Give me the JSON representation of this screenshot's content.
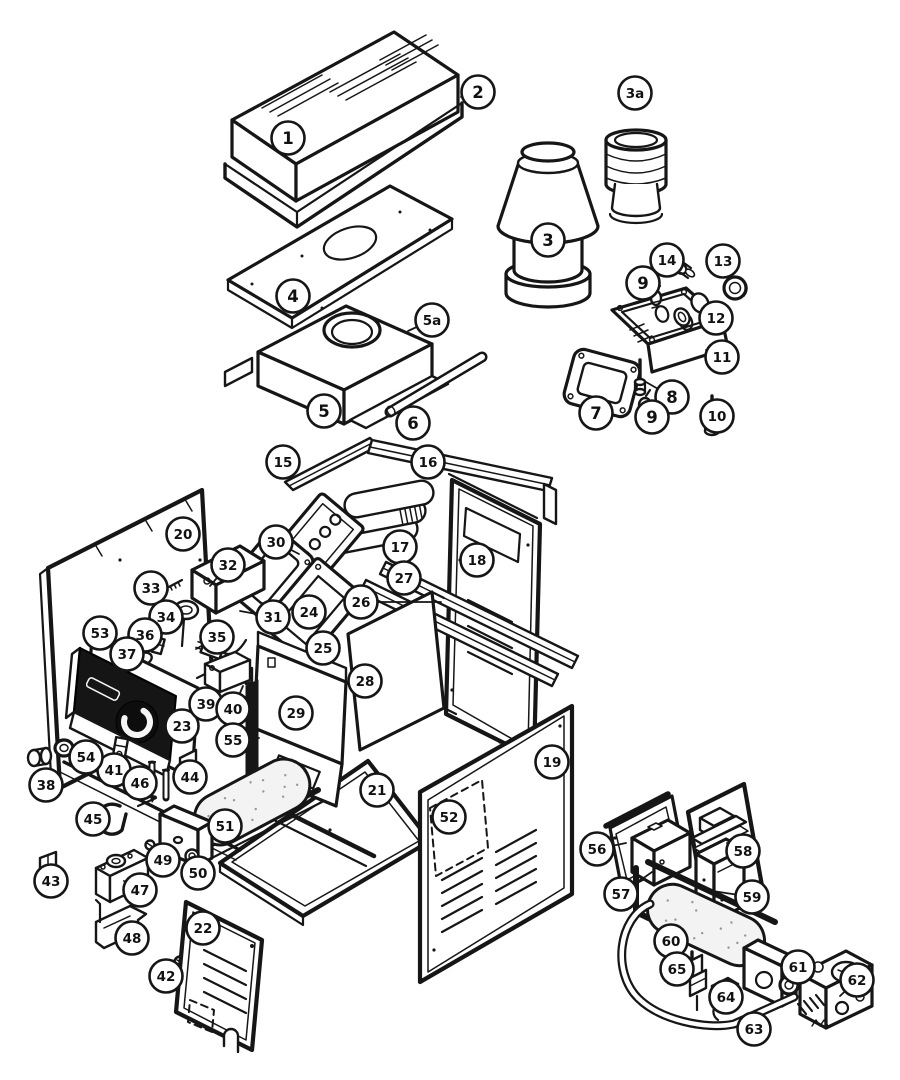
{
  "diagram": {
    "kind": "exploded-parts-diagram"
  },
  "style": {
    "line_color": "#161616",
    "background": "#ffffff",
    "panel_face_color": "#151515",
    "callout_radius": 16.5,
    "callout_font_size": 16.5,
    "callout_font_size_2char": 13.5
  },
  "callouts": [
    {
      "label": "1",
      "x": 288,
      "y": 138
    },
    {
      "label": "2",
      "x": 478,
      "y": 92,
      "leader": [
        461,
        97
      ]
    },
    {
      "label": "3a",
      "x": 635,
      "y": 93
    },
    {
      "label": "3",
      "x": 548,
      "y": 240
    },
    {
      "label": "4",
      "x": 293,
      "y": 296
    },
    {
      "label": "5a",
      "x": 432,
      "y": 320,
      "leader": [
        408,
        331
      ]
    },
    {
      "label": "5",
      "x": 324,
      "y": 411
    },
    {
      "label": "6",
      "x": 413,
      "y": 423
    },
    {
      "label": "7",
      "x": 596,
      "y": 413,
      "leader": [
        604,
        399
      ]
    },
    {
      "label": "8",
      "x": 672,
      "y": 397,
      "leader": [
        646,
        382
      ]
    },
    {
      "label": "9",
      "x": 643,
      "y": 283,
      "leader": [
        653,
        294
      ]
    },
    {
      "label": "9",
      "x": 652,
      "y": 417,
      "leader": [
        648,
        402
      ]
    },
    {
      "label": "10",
      "x": 717,
      "y": 416,
      "leader": [
        713,
        404
      ]
    },
    {
      "label": "11",
      "x": 722,
      "y": 357,
      "leader": [
        706,
        350
      ]
    },
    {
      "label": "12",
      "x": 716,
      "y": 318,
      "leader": [
        701,
        311
      ]
    },
    {
      "label": "13",
      "x": 723,
      "y": 261,
      "leader": [
        731,
        275
      ]
    },
    {
      "label": "14",
      "x": 667,
      "y": 260,
      "leader": [
        676,
        267
      ]
    },
    {
      "label": "15",
      "x": 283,
      "y": 462
    },
    {
      "label": "16",
      "x": 428,
      "y": 462
    },
    {
      "label": "17",
      "x": 400,
      "y": 547
    },
    {
      "label": "18",
      "x": 477,
      "y": 560
    },
    {
      "label": "19",
      "x": 552,
      "y": 762
    },
    {
      "label": "20",
      "x": 183,
      "y": 534
    },
    {
      "label": "21",
      "x": 377,
      "y": 790
    },
    {
      "label": "22",
      "x": 203,
      "y": 928
    },
    {
      "label": "23",
      "x": 182,
      "y": 726
    },
    {
      "label": "24",
      "x": 309,
      "y": 612
    },
    {
      "label": "25",
      "x": 323,
      "y": 648
    },
    {
      "label": "26",
      "x": 361,
      "y": 602,
      "leader": [
        441,
        602
      ]
    },
    {
      "label": "27",
      "x": 404,
      "y": 578
    },
    {
      "label": "28",
      "x": 365,
      "y": 681
    },
    {
      "label": "29",
      "x": 296,
      "y": 713
    },
    {
      "label": "30",
      "x": 276,
      "y": 542,
      "leader": [
        299,
        554
      ]
    },
    {
      "label": "31",
      "x": 273,
      "y": 617,
      "leader": [
        240,
        611
      ]
    },
    {
      "label": "32",
      "x": 228,
      "y": 565,
      "leader": [
        210,
        586
      ]
    },
    {
      "label": "33",
      "x": 151,
      "y": 588
    },
    {
      "label": "34",
      "x": 166,
      "y": 617
    },
    {
      "label": "35",
      "x": 217,
      "y": 637,
      "leader": [
        196,
        649
      ]
    },
    {
      "label": "36",
      "x": 145,
      "y": 635
    },
    {
      "label": "37",
      "x": 127,
      "y": 654
    },
    {
      "label": "38",
      "x": 46,
      "y": 785
    },
    {
      "label": "39",
      "x": 206,
      "y": 704,
      "leader": [
        214,
        690
      ]
    },
    {
      "label": "40",
      "x": 233,
      "y": 709,
      "leader": [
        243,
        686
      ]
    },
    {
      "label": "41",
      "x": 114,
      "y": 770,
      "leader": [
        119,
        758
      ]
    },
    {
      "label": "42",
      "x": 166,
      "y": 976,
      "leader": [
        177,
        967
      ]
    },
    {
      "label": "43",
      "x": 51,
      "y": 881,
      "leader": [
        48,
        869
      ]
    },
    {
      "label": "44",
      "x": 190,
      "y": 777
    },
    {
      "label": "45",
      "x": 93,
      "y": 819
    },
    {
      "label": "46",
      "x": 140,
      "y": 783,
      "leader": [
        151,
        778
      ]
    },
    {
      "label": "47",
      "x": 140,
      "y": 890,
      "leader": [
        124,
        881
      ]
    },
    {
      "label": "48",
      "x": 132,
      "y": 938,
      "leader": [
        118,
        929
      ]
    },
    {
      "label": "49",
      "x": 163,
      "y": 860,
      "leader": [
        157,
        852
      ]
    },
    {
      "label": "50",
      "x": 198,
      "y": 873,
      "leader": [
        194,
        862
      ]
    },
    {
      "label": "51",
      "x": 225,
      "y": 826
    },
    {
      "label": "52",
      "x": 449,
      "y": 817
    },
    {
      "label": "53",
      "x": 100,
      "y": 633,
      "leader": [
        103,
        649
      ]
    },
    {
      "label": "54",
      "x": 86,
      "y": 757,
      "leader": [
        72,
        750
      ]
    },
    {
      "label": "55",
      "x": 233,
      "y": 740,
      "leader": [
        259,
        738
      ]
    },
    {
      "label": "56",
      "x": 597,
      "y": 849,
      "leader": [
        626,
        843
      ]
    },
    {
      "label": "57",
      "x": 621,
      "y": 894,
      "leader": [
        652,
        872
      ]
    },
    {
      "label": "58",
      "x": 743,
      "y": 851,
      "leader": [
        727,
        843
      ]
    },
    {
      "label": "59",
      "x": 752,
      "y": 897,
      "leader": [
        706,
        890
      ]
    },
    {
      "label": "60",
      "x": 671,
      "y": 941
    },
    {
      "label": "61",
      "x": 798,
      "y": 967,
      "leader": [
        791,
        979
      ]
    },
    {
      "label": "62",
      "x": 857,
      "y": 980,
      "leader": [
        840,
        996
      ]
    },
    {
      "label": "63",
      "x": 754,
      "y": 1029,
      "leader": [
        748,
        1018
      ]
    },
    {
      "label": "64",
      "x": 726,
      "y": 997
    },
    {
      "label": "65",
      "x": 677,
      "y": 969
    }
  ]
}
